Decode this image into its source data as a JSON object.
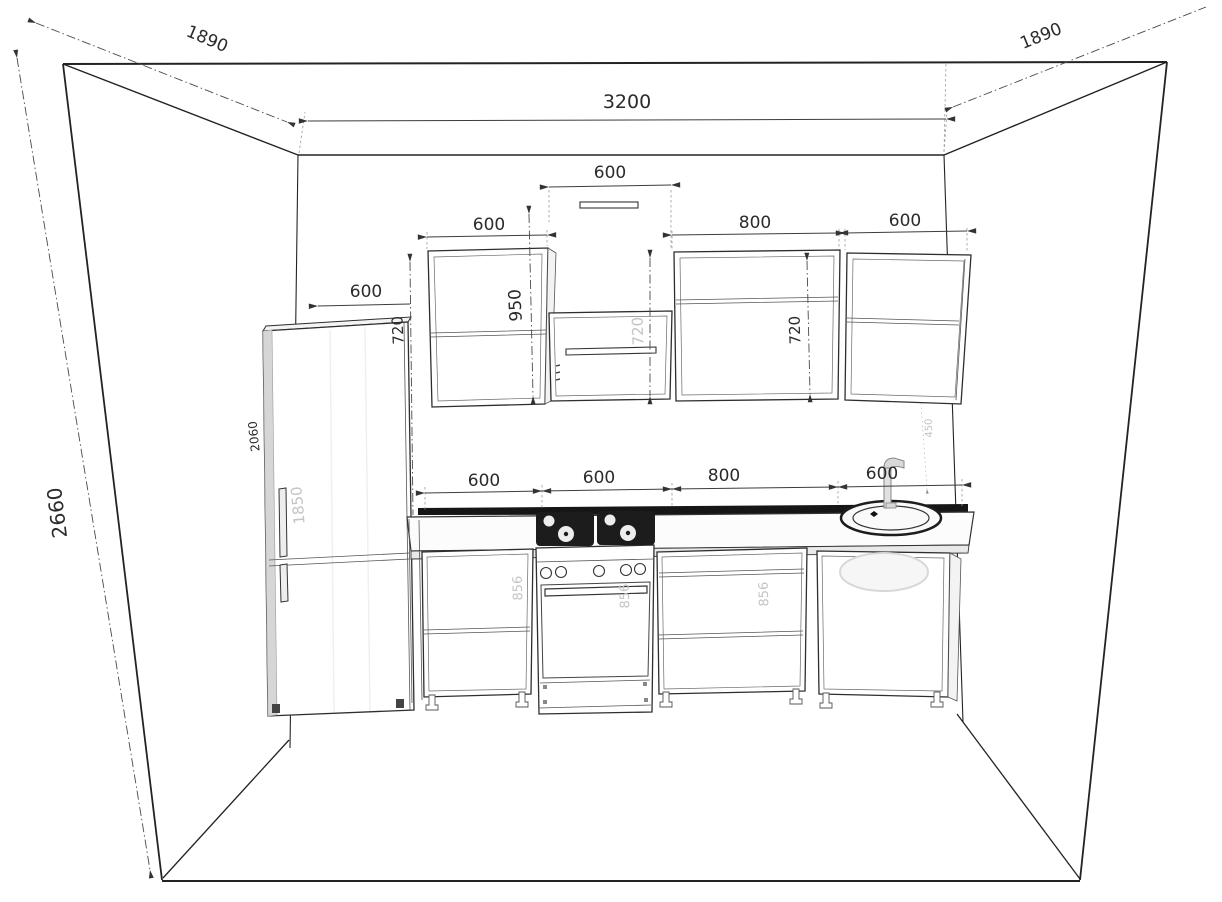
{
  "drawing_type": "kitchen-elevation-3d-wireframe",
  "colors": {
    "line": "#232323",
    "dimension": "#2b2b2b",
    "ghost": "#c4c4c4",
    "backsplash": "#161616",
    "background": "#ffffff"
  },
  "dims": {
    "room_width": "3200",
    "room_height": "2660",
    "side_depth_left": "1890",
    "side_depth_right": "1890",
    "hood_gap_width": "600",
    "upper_left_width": "600",
    "upper_mid_width": "800",
    "upper_right_width": "600",
    "upper_left_total_height": "950",
    "upper_left_height": "720",
    "hood_cabinet_height": "720",
    "upper_mid_height": "720",
    "apron_height": "450",
    "fridge_width": "600",
    "fridge_height": "2060",
    "fridge_door_height": "1850",
    "base_left_width": "600",
    "stove_width": "600",
    "base_mid_width": "800",
    "sink_width": "600",
    "base_left_height": "856",
    "stove_height": "856",
    "base_mid_height": "856"
  }
}
